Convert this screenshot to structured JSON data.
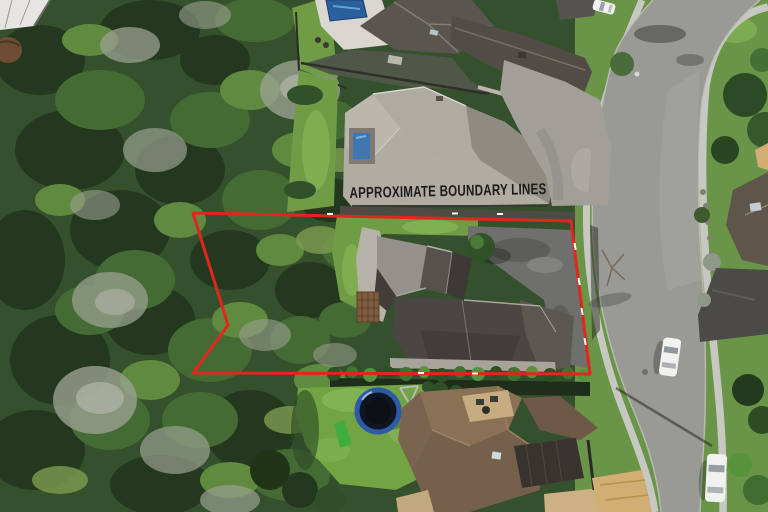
{
  "overlay": {
    "boundary_label": "APPROXIMATE BOUNDARY LINES",
    "boundary_points": "193,213 571,221 590,374 193,373 228,325"
  },
  "palette": {
    "boundary_red": "#e1261d",
    "label_ink": "#1c1c1c",
    "bush_base": "#35502c",
    "bush_dark": "#24381f",
    "bush_mid": "#456b35",
    "bush_light": "#5f8a40",
    "bush_gray": "#9aa08f",
    "lawn_green": "#6f9c45",
    "lawn_bright": "#86b556",
    "verge_green": "#6a9447",
    "road_gray": "#999995",
    "path_gray": "#c8c8c2",
    "concrete": "#a19f98",
    "roof_light_gray": "#b1aca2",
    "roof_dark_gray": "#4a4643",
    "roof_brown": "#7a6450",
    "roof_tan": "#d2ad74",
    "pool_blue": "#2a5f9e",
    "trampoline_blue": "#2d59a8",
    "car_white": "#f1f1ef",
    "driveway_dark": "#4b4a47",
    "hedge_green": "#3f7330"
  }
}
